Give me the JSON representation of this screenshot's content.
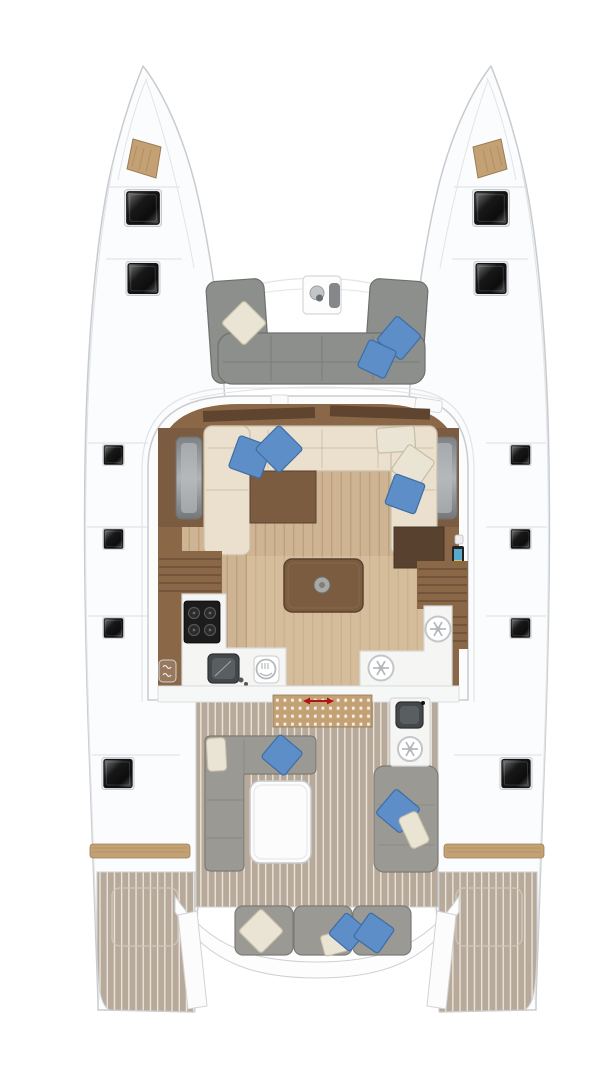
{
  "meta": {
    "type": "yacht-floor-plan",
    "subject": "sailing catamaran deck and saloon layout, top-down view",
    "text_labels": []
  },
  "colors": {
    "bg": "#ffffff",
    "hull_fill": "#fbfcfd",
    "hull_stroke": "#c8cbcf",
    "deck_line": "#e2e4e6",
    "wood_tan": "#c3a175",
    "wood_tan_dark": "#9b7d54",
    "sofa_gray": "#8d8f8c",
    "sofa_gray_dark": "#6e706d",
    "cushion_ivory": "#e9e4d4",
    "cushion_ivory_dark": "#c6bda4",
    "cushion_blue": "#5d8ec7",
    "cushion_blue_dark": "#3e6da5",
    "salon_trim": "#8a6747",
    "salon_trim_dark": "#5f4430",
    "salon_floor": "#cfb493",
    "salon_floor_line": "#b89b78",
    "aisle_light": "#dcc5a4",
    "cream_sofa": "#eae0cd",
    "cream_sofa_stroke": "#cabfa7",
    "walnut": "#7c5c40",
    "walnut_dark": "#58422f",
    "counter_white": "#f5f5f4",
    "counter_stroke": "#d8dad9",
    "steel_dark": "#44484b",
    "steel_inner": "#595e61",
    "icon_gray": "#b5b8ba",
    "icon_ring": "#c3c6c8",
    "cooktop_black": "#1c1c1c",
    "teak": "#b8aa9a",
    "teak_line": "#ece7df",
    "cockpit_sofa": "#9b9994",
    "cockpit_sofa_stroke": "#7d7b76",
    "table_white": "#fcfcfc",
    "window_gray": "#8f9295",
    "screen_blue": "#57aacb",
    "screen_yellow": "#d6c753",
    "arrow_red": "#b11414"
  },
  "areas": [
    "port-hull",
    "starboard-hull",
    "forward-cockpit",
    "saloon",
    "galley",
    "companionway",
    "aft-cockpit",
    "stern-platforms"
  ],
  "inventory": {
    "deck_hatches": 12,
    "blue_cushions": 9,
    "ivory_cushions": 6,
    "fridge_freezer_units": 3,
    "sinks": 3,
    "cooktop_burners": 4
  },
  "icons": {
    "hatch": "dark glossy square with frame",
    "cooktop": "4 burner circles on black",
    "sink": "dark rounded square with faucet dot",
    "oven-icon": "circle with fork glyph",
    "fridge-icon": "circle with snowflake lines",
    "slide-arrow-icon": "red double-headed arrow on dotted door track",
    "nav-screen": "small blue/yellow display panel",
    "vent-icon": "rounded square with wavy lines"
  }
}
